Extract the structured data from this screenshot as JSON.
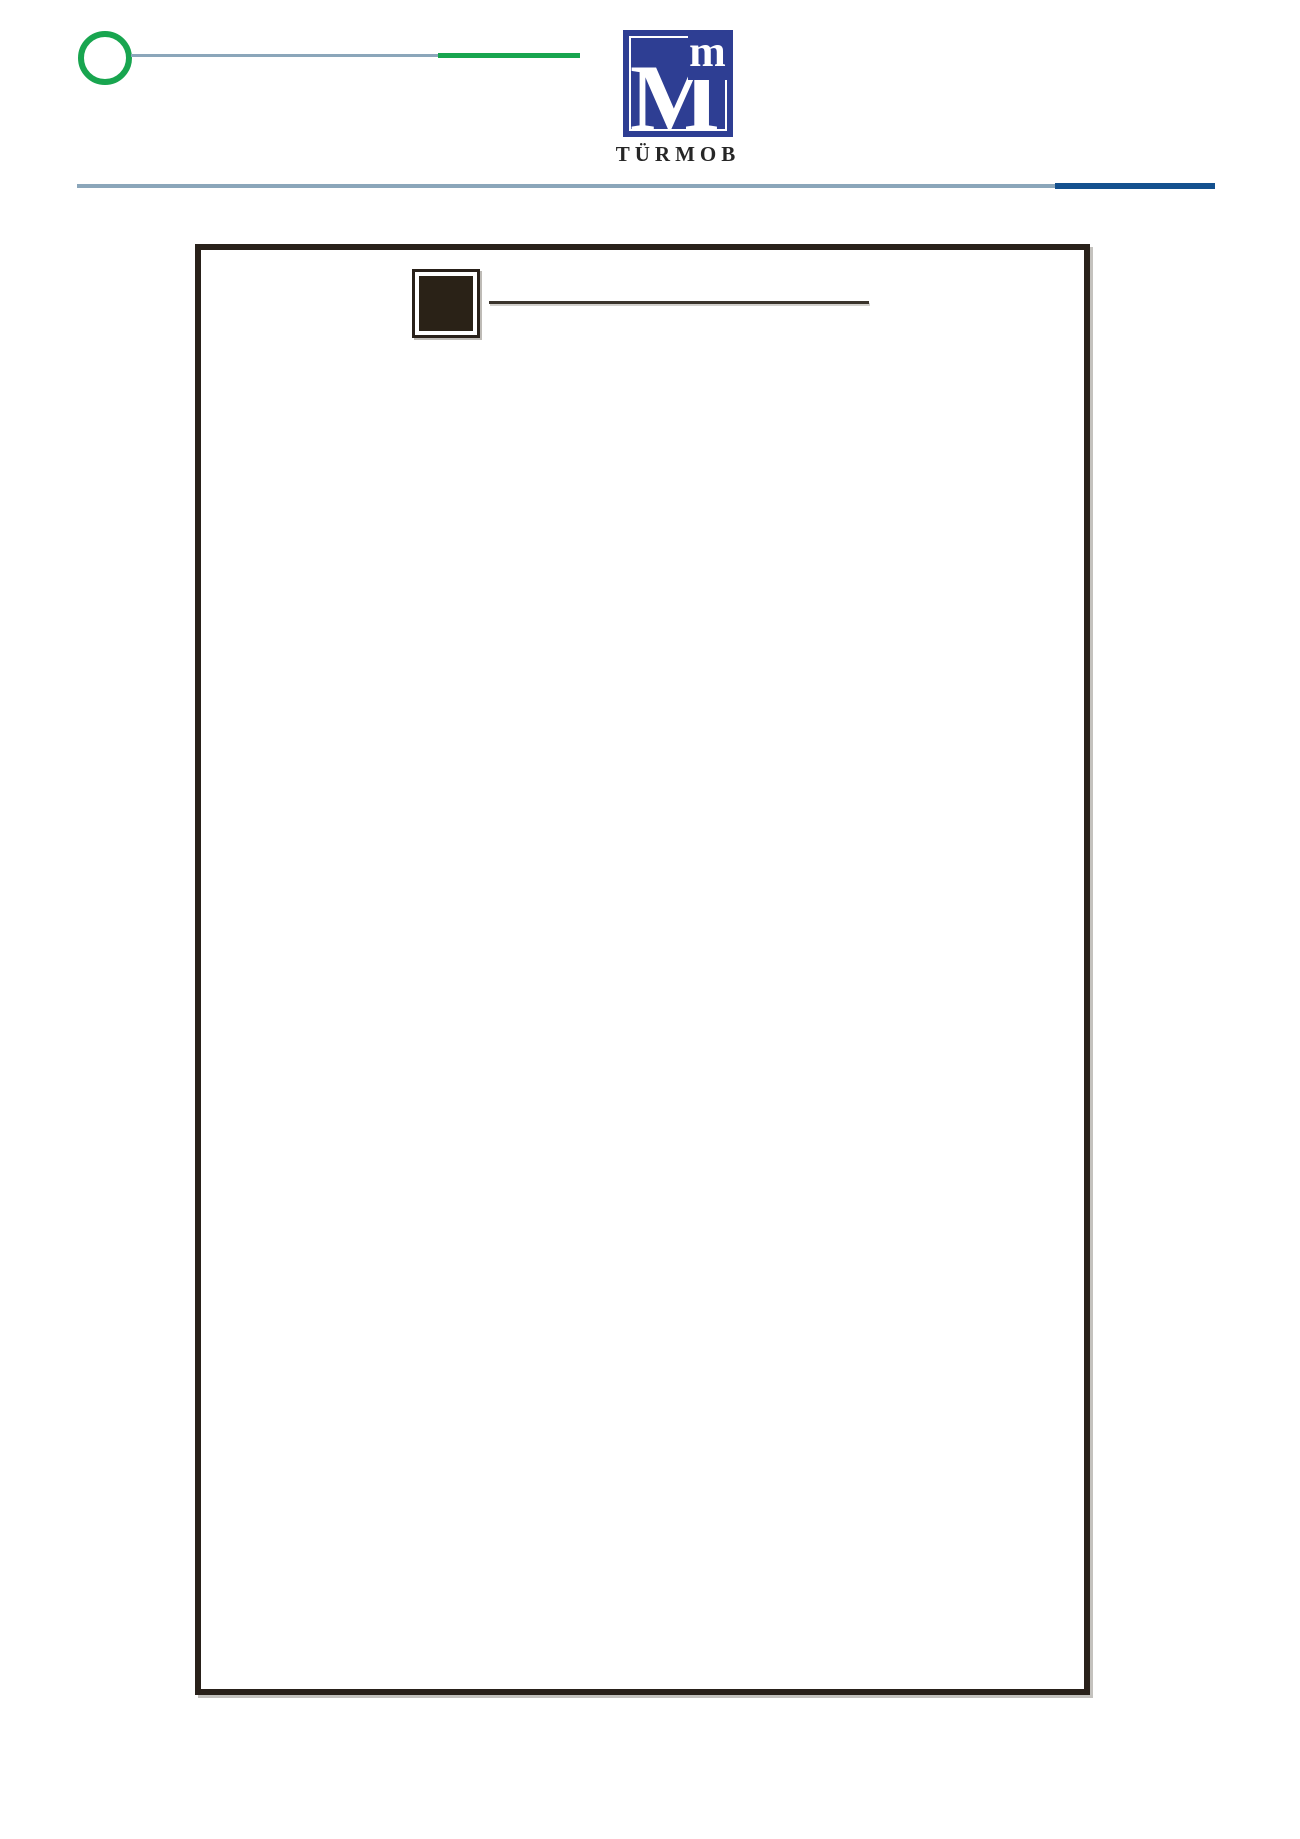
{
  "page": {
    "width_px": 1300,
    "height_px": 1839,
    "background": "#ffffff"
  },
  "header": {
    "decoration": {
      "circle_color": "#18a54f",
      "connector_line_color": "#8ba6ba",
      "accent_line_color": "#18a54f"
    },
    "logo": {
      "main_letter": "M",
      "small_letter": "m",
      "brand_name": "TÜRMOB",
      "square_color": "#2e3e93",
      "letter_color": "#ffffff",
      "brand_text_color": "#262626"
    },
    "divider": {
      "line_color": "#8ba6ba",
      "accent_color": "#14508e"
    }
  },
  "content_frame": {
    "border_color": "#29211a",
    "section_marker": {
      "bullet_square_color": "#2a2217",
      "title_rule_color": "#3a342c"
    }
  }
}
